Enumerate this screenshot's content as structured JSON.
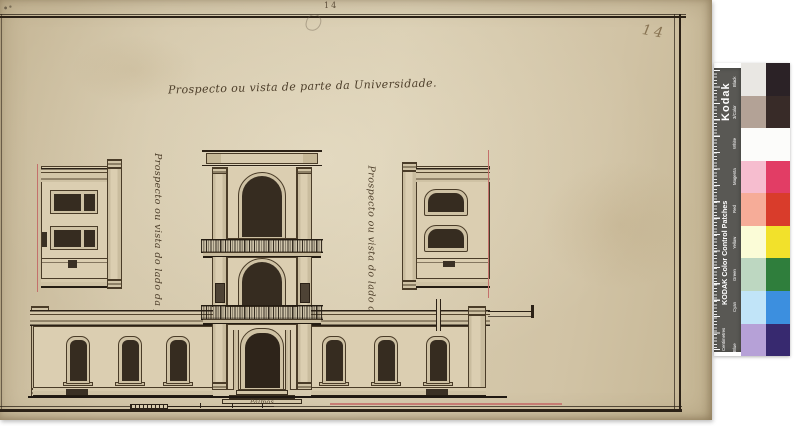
{
  "palette": {
    "paper": "#d3c6a9",
    "ink": "#2b2116",
    "red_reference_line": "#c4706b",
    "window_dark": "#362c20",
    "wall_wash": "#dbceb1",
    "ruler_gray": "#595854",
    "scan_background": "#ffffff"
  },
  "page": {
    "printed_folio": "14",
    "handwritten_folio": "14"
  },
  "drawing": {
    "title": "Prospecto ou vista de parte da Universidade.",
    "left_caption": "Prospecto ou vista do lado da fachada.",
    "right_caption": "Prospecto ou vista do lado do Sul.",
    "scale_label": "Palmos"
  },
  "kodak": {
    "brand": "Kodak",
    "title": "KODAK Color Control Patches",
    "ruler_unit": "Centimetres",
    "patches": [
      {
        "label": "Black",
        "tint": "#e9e7e3",
        "full": "#2b2226"
      },
      {
        "label": "3/Color",
        "tint": "#b3a296",
        "full": "#382b28"
      },
      {
        "label": "White",
        "tint": "#fcfcfa",
        "full": "#fcfcfa"
      },
      {
        "label": "Magenta",
        "tint": "#f6bdcf",
        "full": "#e23d65"
      },
      {
        "label": "Red",
        "tint": "#f6ac98",
        "full": "#d93c2b"
      },
      {
        "label": "Yellow",
        "tint": "#fbfcd7",
        "full": "#f2e12b"
      },
      {
        "label": "Green",
        "tint": "#bdd7c1",
        "full": "#2f7e3c"
      },
      {
        "label": "Cyan",
        "tint": "#c1e4f8",
        "full": "#3c8fdf"
      },
      {
        "label": "Blue",
        "tint": "#b6a1d7",
        "full": "#37296f"
      }
    ]
  }
}
